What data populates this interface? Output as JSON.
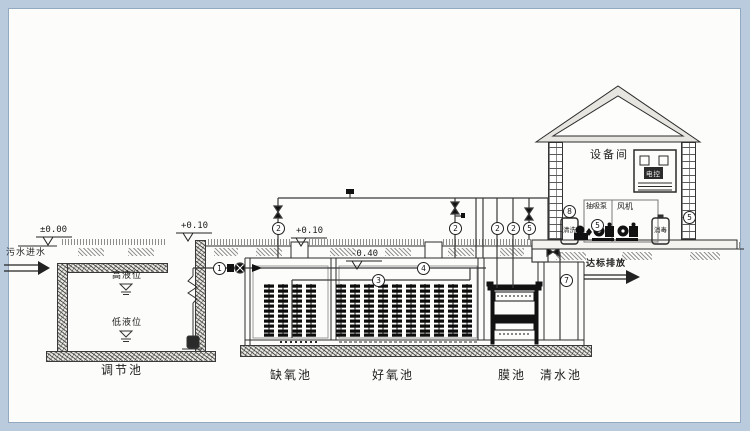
{
  "scene": {
    "frame_color": "#b9cbdd",
    "paper_color": "#fcfcfa",
    "ink_color": "#2b2b2b"
  },
  "flow": {
    "inlet": "污水进水",
    "discharge": "达标排放"
  },
  "tanks": {
    "regulation": "调节池",
    "anoxic": "缺氧池",
    "aerobic": "好氧池",
    "membrane": "膜池",
    "clearwater": "清水池",
    "high_level": "高液位",
    "low_level": "低液位"
  },
  "equipment_room": {
    "title": "设备间",
    "cabinet": "电控",
    "suction_pump": "抽吸泵",
    "blower": "风机",
    "tank_left": "清洗",
    "tank_right": "消毒"
  },
  "elevations": {
    "ground": "±0.00",
    "reg_wall": "+0.10",
    "tank_wall": "+0.10",
    "water": "-0.40"
  },
  "tags": [
    {
      "num": "1",
      "x": 219,
      "y": 268
    },
    {
      "num": "4",
      "x": 423,
      "y": 268
    },
    {
      "num": "3",
      "x": 378,
      "y": 280
    },
    {
      "num": "2",
      "x": 278,
      "y": 228
    },
    {
      "num": "2",
      "x": 455,
      "y": 228
    },
    {
      "num": "2",
      "x": 497,
      "y": 228
    },
    {
      "num": "2",
      "x": 513,
      "y": 228
    },
    {
      "num": "5",
      "x": 529,
      "y": 228
    },
    {
      "num": "7",
      "x": 566,
      "y": 280
    },
    {
      "num": "8",
      "x": 569,
      "y": 211
    },
    {
      "num": "5",
      "x": 597,
      "y": 225
    },
    {
      "num": "5",
      "x": 689,
      "y": 217
    }
  ]
}
